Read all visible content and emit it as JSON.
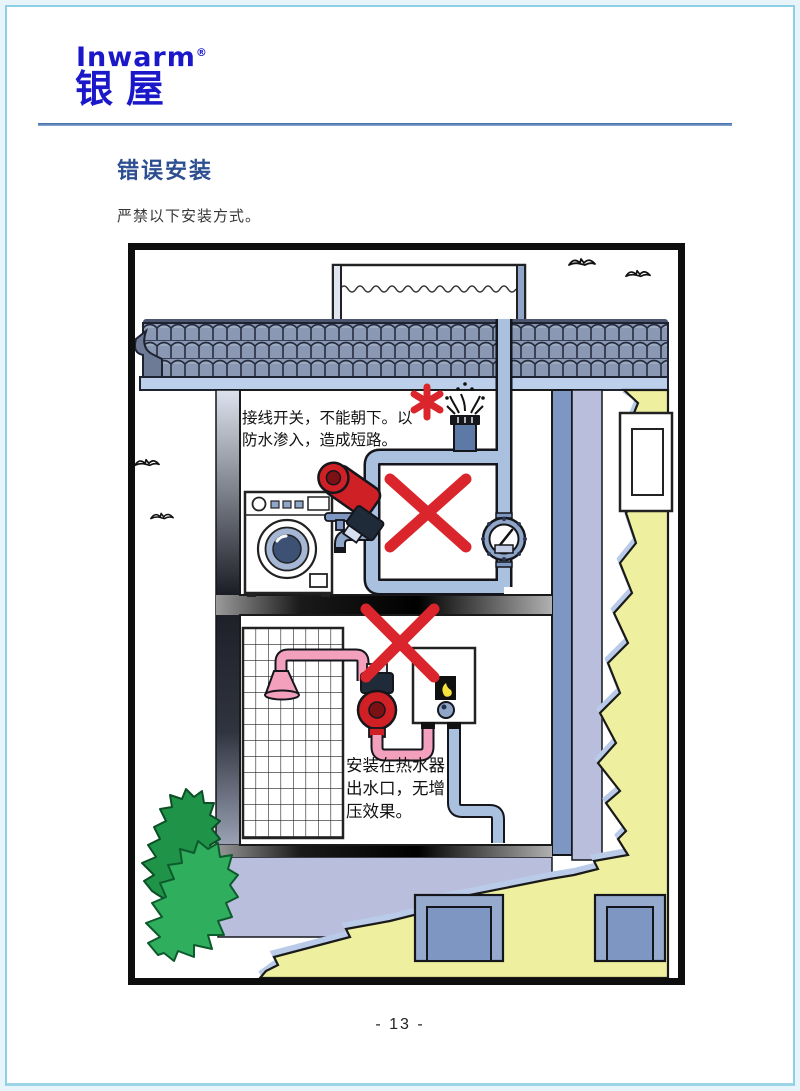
{
  "header": {
    "logo_latin": "Inwarm",
    "logo_reg_mark": "®",
    "logo_cjk": "银屋"
  },
  "content": {
    "section_title": "错误安装",
    "intro_text": "严禁以下安装方式。"
  },
  "figure": {
    "note_top_line1": "接线开关，不能朝下。以",
    "note_top_line2": "防水渗入，造成短路。",
    "note_bottom_line1": "安装在热水器",
    "note_bottom_line2": "出水口，无增",
    "note_bottom_line3": "压效果。",
    "symbols": {
      "footnote_asterisk": "✱",
      "prohibition_cross": "✕"
    }
  },
  "footer": {
    "page_number": "- 13 -"
  },
  "colors": {
    "brand_blue": "#1b18c9",
    "rule_blue": "#4f77b3",
    "heading_blue": "#2d4f92",
    "text_dark": "#383838",
    "frame_black": "#0e0e0e",
    "pipe_blue": "#a9c0de",
    "pipe_outline": "#14161c",
    "fixture_blue": "#7e96c2",
    "roof_tile_blue": "#8b98b3",
    "fascia_blue": "#bccfeb",
    "wall_lavender": "#b9bedd",
    "wall_yellow": "#eef0a0",
    "bush_green": "#2fae5d",
    "bush_green_dark": "#1f9448",
    "pump_red": "#cf2026",
    "pink_pipe": "#f2a0bc",
    "error_red": "#d9252b",
    "page_edge_blue": "#8ccfe6"
  }
}
